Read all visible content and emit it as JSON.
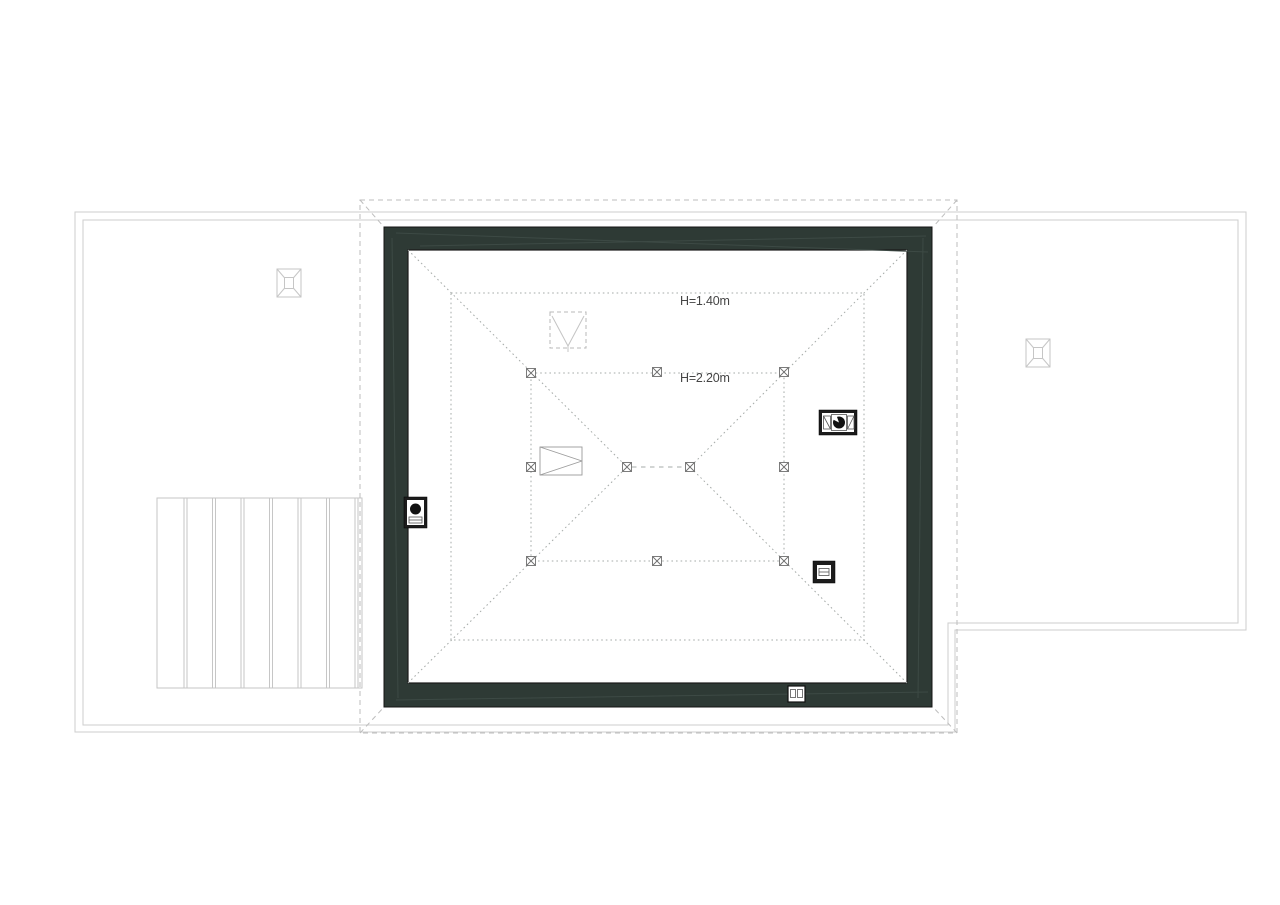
{
  "plan": {
    "type": "architectural-attic-roof-plan",
    "labels": {
      "h140": "H=1.40m",
      "h220": "H=2.20m"
    },
    "colors": {
      "background": "#ffffff",
      "wall_fill": "#2e3a35",
      "outline_gray": "#cdcdcd",
      "dashed_gray": "#bdbdbd",
      "dotted_gray": "#a6aba9",
      "symbol_black": "#1c1c1c",
      "label_text": "#454545"
    },
    "icons": [
      "roof-window-icon",
      "chimney-icon",
      "fan-unit-icon",
      "vent-box-icon",
      "wall-vent-icon",
      "window-opening-icon",
      "flue-shaft-icon",
      "post-marker-icon"
    ]
  }
}
